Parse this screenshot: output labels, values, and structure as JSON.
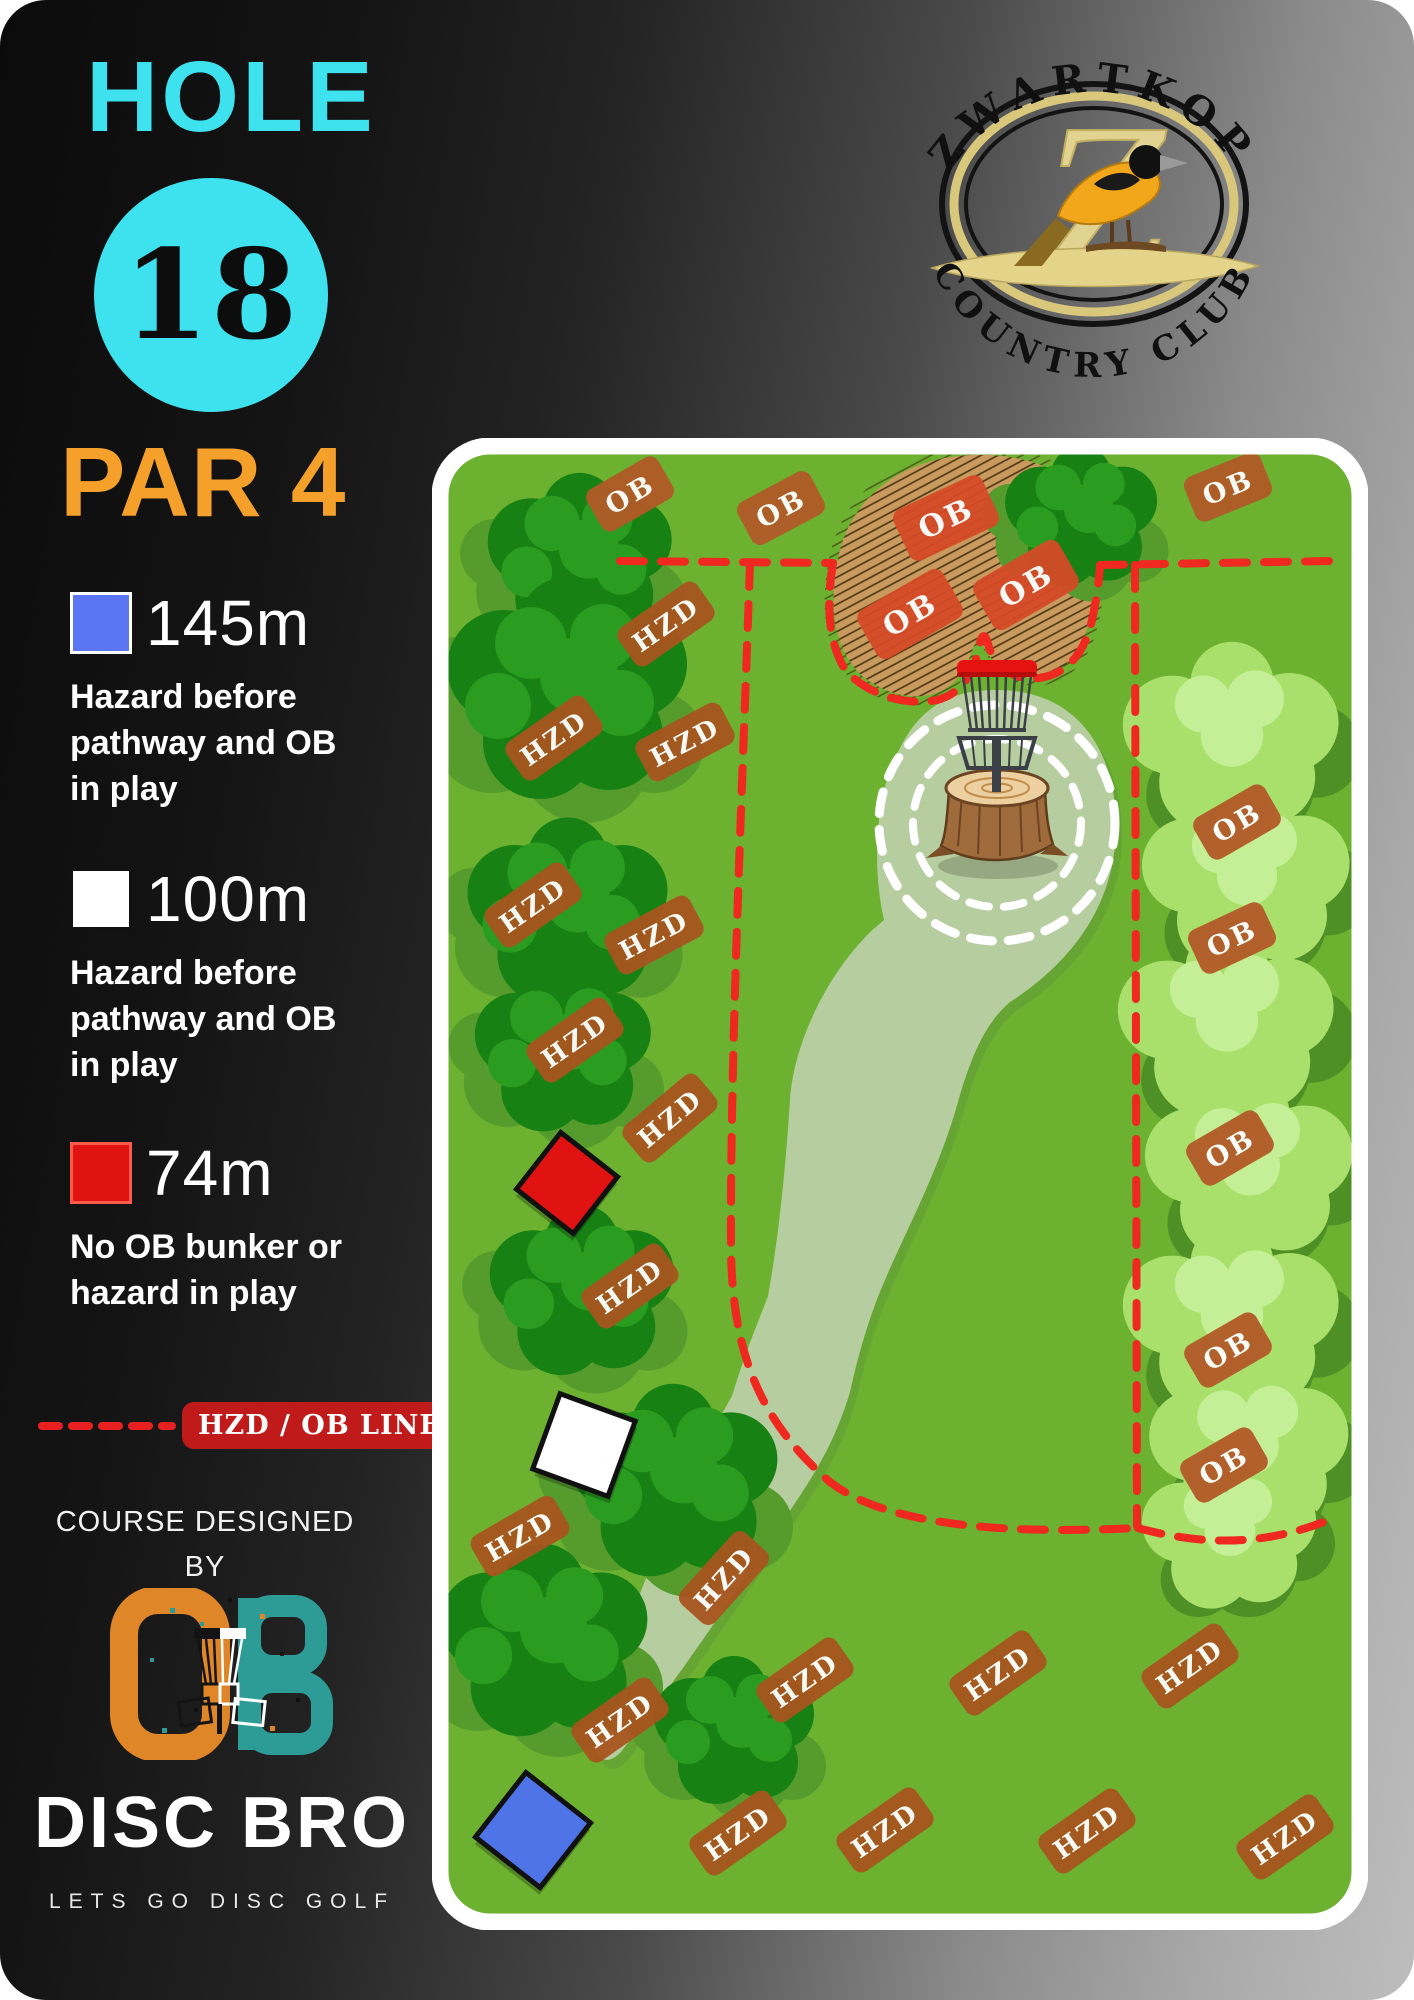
{
  "header": {
    "hole_label": "HOLE",
    "hole_number": "18",
    "par_label": "PAR 4"
  },
  "legend": {
    "tees": [
      {
        "color_name": "blue",
        "color": "#5b76f2",
        "distance": "145m",
        "description": "Hazard before\npathway and OB\nin play"
      },
      {
        "color_name": "white",
        "color": "#ffffff",
        "distance": "100m",
        "description": "Hazard before\npathway and OB\nin play"
      },
      {
        "color_name": "red",
        "color": "#e01212",
        "distance": "74m",
        "description": "No OB bunker or\nhazard in play"
      }
    ],
    "line_label": "HZD / OB LINE",
    "line_color": "#e82020"
  },
  "credits": {
    "designed_by": "COURSE DESIGNED\nBY",
    "brand": "DISC BRO",
    "tagline": "LETS GO DISC GOLF"
  },
  "club_logo": {
    "top_text": "ZWARTKOP",
    "bottom_text": "COUNTRY CLUB",
    "monogram": "Z"
  },
  "colors": {
    "accent_cyan": "#3ee2ee",
    "accent_orange": "#f5a02a",
    "field_green": "#6cb12f",
    "fairway_sage": "#b6cd9f",
    "bunker_tan": "#c89a5e",
    "badge_rust": "#a8551f",
    "badge_red": "#d54b27",
    "ob_line_red": "#ef2820",
    "brand_orange": "#df8629",
    "brand_teal": "#2d9c96"
  },
  "map": {
    "badges": [
      {
        "label": "HZD",
        "x": 234,
        "y": 186,
        "rot": -35,
        "kind": "hzd"
      },
      {
        "label": "HZD",
        "x": 122,
        "y": 300,
        "rot": -35,
        "kind": "hzd"
      },
      {
        "label": "HZD",
        "x": 253,
        "y": 304,
        "rot": -28,
        "kind": "hzd"
      },
      {
        "label": "HZD",
        "x": 101,
        "y": 467,
        "rot": -35,
        "kind": "hzd"
      },
      {
        "label": "HZD",
        "x": 222,
        "y": 497,
        "rot": -28,
        "kind": "hzd"
      },
      {
        "label": "HZD",
        "x": 143,
        "y": 602,
        "rot": -35,
        "kind": "hzd"
      },
      {
        "label": "HZD",
        "x": 238,
        "y": 680,
        "rot": -40,
        "kind": "hzd"
      },
      {
        "label": "HZD",
        "x": 198,
        "y": 848,
        "rot": -35,
        "kind": "hzd"
      },
      {
        "label": "HZD",
        "x": 88,
        "y": 1098,
        "rot": -30,
        "kind": "hzd"
      },
      {
        "label": "HZD",
        "x": 292,
        "y": 1140,
        "rot": -48,
        "kind": "hzd"
      },
      {
        "label": "HZD",
        "x": 188,
        "y": 1282,
        "rot": -35,
        "kind": "hzd"
      },
      {
        "label": "HZD",
        "x": 373,
        "y": 1242,
        "rot": -35,
        "kind": "hzd"
      },
      {
        "label": "HZD",
        "x": 306,
        "y": 1395,
        "rot": -35,
        "kind": "hzd"
      },
      {
        "label": "HZD",
        "x": 453,
        "y": 1392,
        "rot": -35,
        "kind": "hzd"
      },
      {
        "label": "HZD",
        "x": 566,
        "y": 1235,
        "rot": -35,
        "kind": "hzd"
      },
      {
        "label": "HZD",
        "x": 758,
        "y": 1228,
        "rot": -35,
        "kind": "hzd"
      },
      {
        "label": "HZD",
        "x": 655,
        "y": 1393,
        "rot": -35,
        "kind": "hzd"
      },
      {
        "label": "HZD",
        "x": 853,
        "y": 1399,
        "rot": -35,
        "kind": "hzd"
      },
      {
        "label": "OB",
        "x": 198,
        "y": 56,
        "rot": -30,
        "kind": "ob"
      },
      {
        "label": "OB",
        "x": 349,
        "y": 70,
        "rot": -28,
        "kind": "ob"
      },
      {
        "label": "OB",
        "x": 796,
        "y": 49,
        "rot": -22,
        "kind": "ob"
      },
      {
        "label": "OB",
        "x": 514,
        "y": 80,
        "rot": -25,
        "kind": "obred"
      },
      {
        "label": "OB",
        "x": 594,
        "y": 147,
        "rot": -30,
        "kind": "obred"
      },
      {
        "label": "OB",
        "x": 478,
        "y": 176,
        "rot": -30,
        "kind": "obred"
      },
      {
        "label": "OB",
        "x": 805,
        "y": 384,
        "rot": -30,
        "kind": "ob"
      },
      {
        "label": "OB",
        "x": 800,
        "y": 500,
        "rot": -25,
        "kind": "ob"
      },
      {
        "label": "OB",
        "x": 798,
        "y": 710,
        "rot": -30,
        "kind": "ob"
      },
      {
        "label": "OB",
        "x": 796,
        "y": 912,
        "rot": -30,
        "kind": "ob"
      },
      {
        "label": "OB",
        "x": 792,
        "y": 1027,
        "rot": -30,
        "kind": "ob"
      }
    ],
    "trees": [
      {
        "x": 150,
        "y": 120,
        "s": 1.15,
        "kind": "dark"
      },
      {
        "x": 138,
        "y": 250,
        "s": 1.5,
        "kind": "dark"
      },
      {
        "x": 138,
        "y": 472,
        "s": 1.25,
        "kind": "dark"
      },
      {
        "x": 133,
        "y": 612,
        "s": 1.1,
        "kind": "dark"
      },
      {
        "x": 152,
        "y": 852,
        "s": 1.15,
        "kind": "dark"
      },
      {
        "x": 244,
        "y": 1042,
        "s": 1.3,
        "kind": "dark"
      },
      {
        "x": 114,
        "y": 1202,
        "s": 1.3,
        "kind": "dark"
      },
      {
        "x": 304,
        "y": 1292,
        "s": 1.0,
        "kind": "dark"
      },
      {
        "x": 651,
        "y": 78,
        "s": 0.95,
        "kind": "dark"
      },
      {
        "x": 800,
        "y": 300,
        "s": 1.3,
        "kind": "light"
      },
      {
        "x": 815,
        "y": 440,
        "s": 1.25,
        "kind": "light"
      },
      {
        "x": 795,
        "y": 585,
        "s": 1.3,
        "kind": "light"
      },
      {
        "x": 818,
        "y": 730,
        "s": 1.25,
        "kind": "light"
      },
      {
        "x": 800,
        "y": 880,
        "s": 1.3,
        "kind": "light"
      },
      {
        "x": 818,
        "y": 1010,
        "s": 1.2,
        "kind": "light"
      },
      {
        "x": 798,
        "y": 1095,
        "s": 1.05,
        "kind": "light"
      }
    ],
    "tees": [
      {
        "name": "red-tee",
        "x": 135,
        "y": 745,
        "size": 72,
        "rot": 38,
        "fill": "#e01212",
        "stroke": "#111111"
      },
      {
        "name": "white-tee",
        "x": 152,
        "y": 1007,
        "size": 80,
        "rot": 20,
        "fill": "#ffffff",
        "stroke": "#111111"
      },
      {
        "name": "blue-tee",
        "x": 101,
        "y": 1392,
        "size": 82,
        "rot": 38,
        "fill": "#4f74e8",
        "stroke": "#111111"
      }
    ]
  }
}
